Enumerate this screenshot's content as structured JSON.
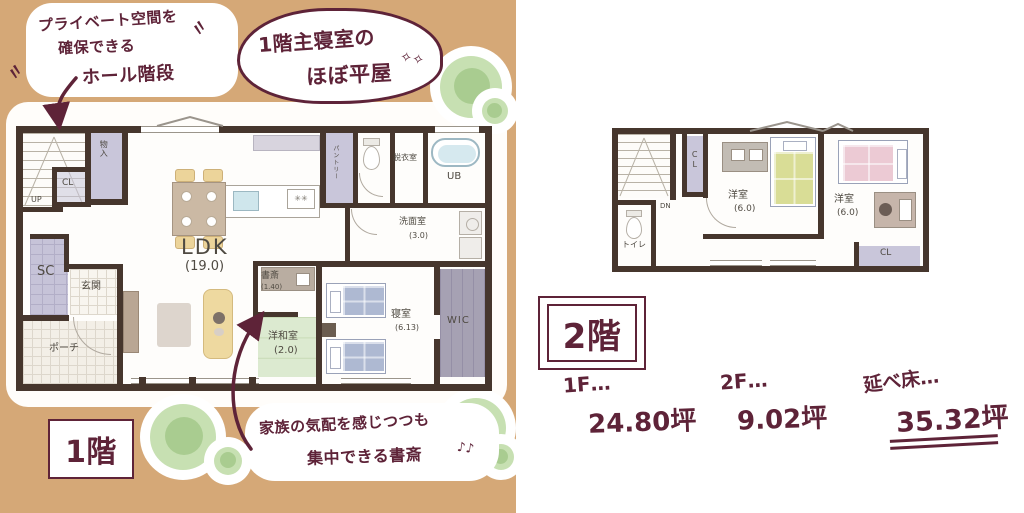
{
  "colors": {
    "background_left": "#d5a877",
    "accent_ink": "#5e2338",
    "plan_ink": "#4f4a42",
    "wall": "#46362d",
    "closet": "#c9c6da",
    "tatami": "#dcead0",
    "tree": "#a9cc90"
  },
  "bubbles": {
    "hall": {
      "line1": "プライベート空間を",
      "line2": "確保できる",
      "line3": "ホール階段"
    },
    "hiraya": {
      "line1": "1階主寝室の",
      "line2": "ほぼ平屋",
      "sparkles": "✧✧"
    },
    "study": {
      "line1": "家族の気配を感じつつも",
      "line2": "集中できる書斎",
      "notes": "♪♪"
    }
  },
  "floor1": {
    "tag": "1階",
    "ldk": {
      "name": "LDK",
      "size": "(19.0)"
    },
    "study": {
      "name": "書斎",
      "size": "(1.40)"
    },
    "youwashitsu": {
      "name": "洋和室",
      "size": "(2.0)"
    },
    "bedroom": {
      "name": "寝室",
      "size": "(6.13)"
    },
    "wic": "WIC",
    "senmen": {
      "name": "洗面室",
      "size": "(3.0)"
    },
    "datsui": "脱衣室",
    "ub": "UB",
    "pantry": "パントリー",
    "monoire": "物入",
    "cl": "CL",
    "sc": "SC",
    "genkan": "玄関",
    "porch": "ポーチ",
    "up": "UP"
  },
  "floor2": {
    "tag": "2階",
    "room1": {
      "name": "洋室",
      "size": "(6.0)"
    },
    "room2": {
      "name": "洋室",
      "size": "(6.0)"
    },
    "cl_hall": "CL",
    "cl_room2": "CL",
    "toilet": "トイレ",
    "dn": "DN"
  },
  "areas": {
    "f1_label": "1F…",
    "f1_value": "24.80坪",
    "f2_label": "2F…",
    "f2_value": "9.02坪",
    "total_label": "延べ床…",
    "total_value": "35.32坪"
  }
}
